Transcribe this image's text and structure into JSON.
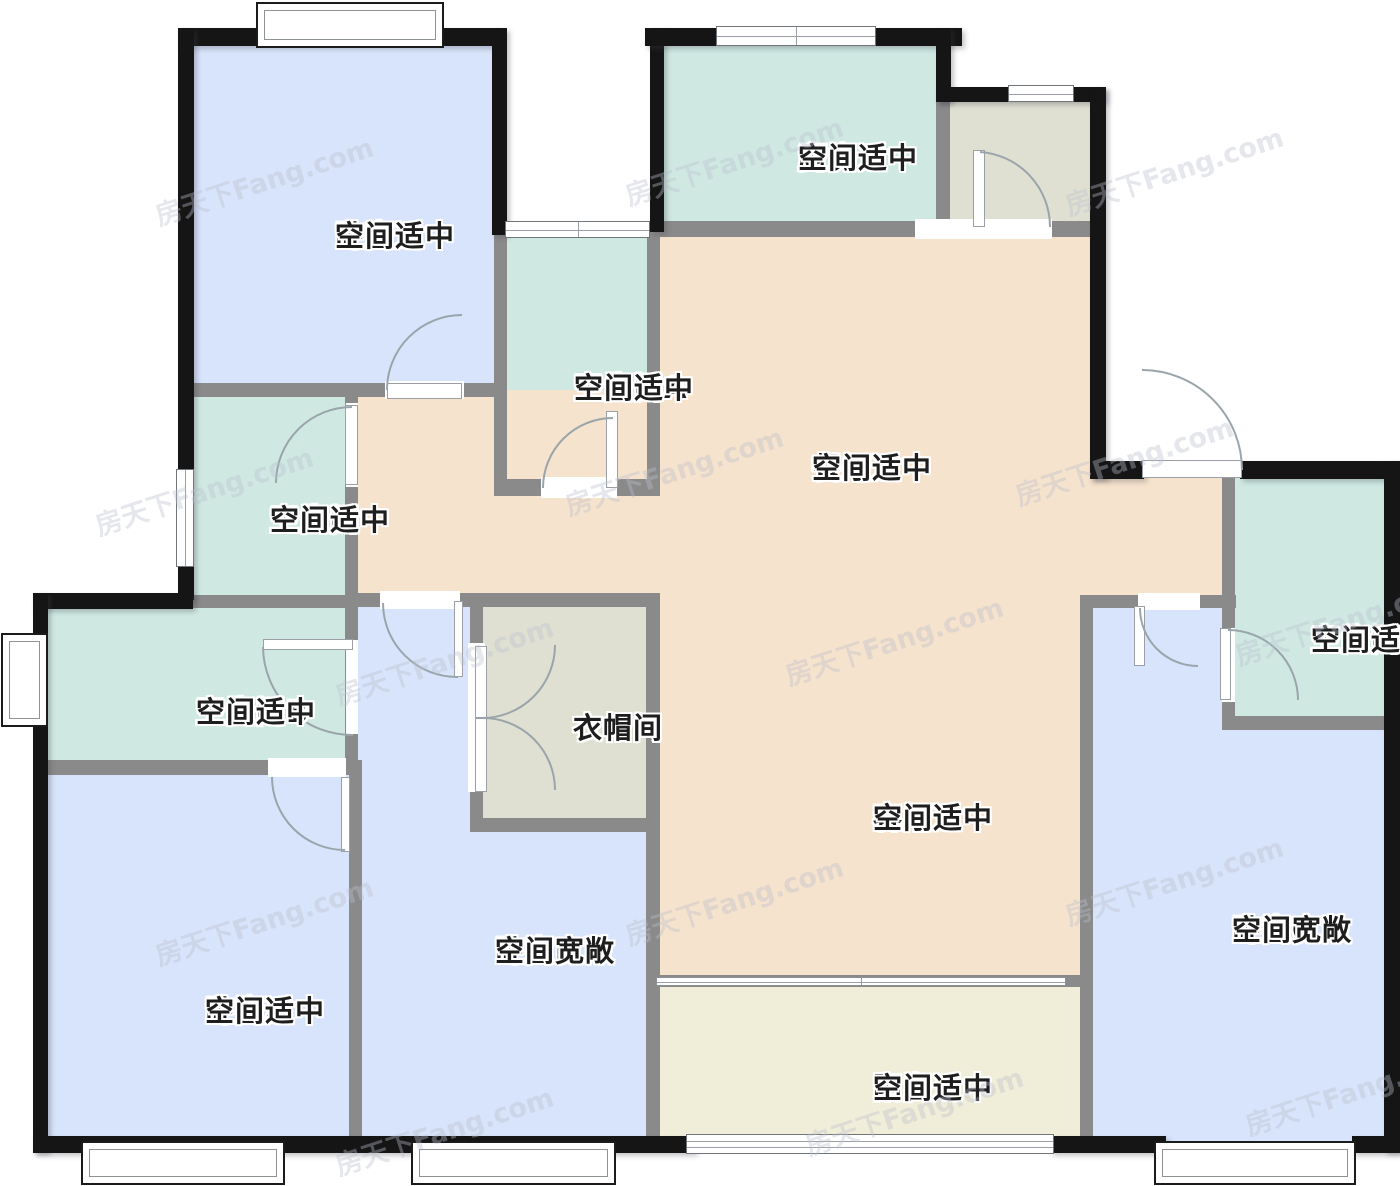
{
  "title": "户型图",
  "watermark": {
    "text": "房天下Fang.com",
    "positions": [
      [
        150,
        160
      ],
      [
        620,
        140
      ],
      [
        1060,
        150
      ],
      [
        90,
        470
      ],
      [
        560,
        450
      ],
      [
        1010,
        440
      ],
      [
        330,
        640
      ],
      [
        780,
        620
      ],
      [
        1230,
        600
      ],
      [
        150,
        900
      ],
      [
        620,
        880
      ],
      [
        1060,
        860
      ],
      [
        330,
        1110
      ],
      [
        800,
        1090
      ],
      [
        1240,
        1070
      ]
    ]
  },
  "palette": {
    "blue": "#d8e4fb",
    "teal": "#cfe9e2",
    "peach": "#f6e3cd",
    "sage": "#dfe0d2",
    "cream": "#f0eed9",
    "wall": "#151515",
    "partition": "#8a8a8a",
    "arc": "#9aa5ab",
    "label": "#1e1e1e"
  },
  "rooms": [
    {
      "id": "bedroom-tl",
      "name": "卧室",
      "desc": "空间适中",
      "lx": 335,
      "ly": 218,
      "fill": "blue",
      "rects": [
        [
          186,
          36,
          310,
          351
        ]
      ]
    },
    {
      "id": "kitchen",
      "name": "厨房",
      "desc": "空间适中",
      "lx": 798,
      "ly": 140,
      "fill": "teal",
      "rects": [
        [
          652,
          40,
          290,
          187
        ]
      ]
    },
    {
      "id": "utility",
      "name": "",
      "desc": "",
      "lx": 0,
      "ly": 0,
      "fill": "sage",
      "rects": [
        [
          944,
          96,
          152,
          131
        ]
      ]
    },
    {
      "id": "bath-a",
      "name": "卫生间A",
      "desc": "空间适中",
      "lx": 574,
      "ly": 370,
      "fill": "teal",
      "rects": [
        [
          500,
          231,
          150,
          256
        ]
      ]
    },
    {
      "id": "dining",
      "name": "餐厅",
      "desc": "空间适中",
      "lx": 812,
      "ly": 450,
      "fill": "peach",
      "rects": [
        [
          652,
          230,
          445,
          258
        ],
        [
          352,
          390,
          305,
          212
        ],
        [
          1088,
          470,
          142,
          135
        ]
      ]
    },
    {
      "id": "living",
      "name": "客厅",
      "desc": "空间适中",
      "lx": 873,
      "ly": 800,
      "fill": "peach",
      "rects": [
        [
          652,
          480,
          436,
          505
        ]
      ]
    },
    {
      "id": "bath",
      "name": "卫生间",
      "desc": "空间适中",
      "lx": 270,
      "ly": 502,
      "fill": "teal",
      "rects": [
        [
          186,
          390,
          166,
          212
        ]
      ]
    },
    {
      "id": "bath-b",
      "name": "卫生间B",
      "desc": "空间适中",
      "lx": 196,
      "ly": 694,
      "fill": "teal",
      "rects": [
        [
          40,
          600,
          312,
          168
        ]
      ]
    },
    {
      "id": "bedroom-a",
      "name": "卧室A",
      "desc": "空间适中",
      "lx": 205,
      "ly": 993,
      "fill": "blue",
      "rects": [
        [
          40,
          768,
          316,
          375
        ]
      ]
    },
    {
      "id": "bedroom-b",
      "name": "卧室B",
      "desc": "空间宽敞",
      "lx": 495,
      "ly": 933,
      "fill": "blue",
      "rects": [
        [
          355,
          600,
          298,
          543
        ]
      ]
    },
    {
      "id": "cloak",
      "name": "衣帽间",
      "desc": "",
      "lx": 573,
      "ly": 710,
      "fill": "sage",
      "rects": [
        [
          476,
          600,
          178,
          226
        ]
      ]
    },
    {
      "id": "balcony",
      "name": "阳台",
      "desc": "空间适中",
      "lx": 873,
      "ly": 1070,
      "fill": "cream",
      "rects": [
        [
          652,
          980,
          436,
          163
        ]
      ]
    },
    {
      "id": "bedroom-c",
      "name": "卧室C",
      "desc": "空间宽敞",
      "lx": 1232,
      "ly": 912,
      "fill": "blue",
      "rects": [
        [
          1088,
          600,
          300,
          543
        ]
      ]
    },
    {
      "id": "bath-c",
      "name": "卫生间C",
      "desc": "空间适中",
      "lx": 1311,
      "ly": 622,
      "fill": "teal",
      "rects": [
        [
          1228,
          475,
          160,
          248
        ]
      ]
    }
  ],
  "walls": {
    "exterior": [
      [
        178,
        28,
        319,
        18
      ],
      [
        178,
        28,
        16,
        572
      ],
      [
        492,
        28,
        15,
        207
      ],
      [
        33,
        593,
        160,
        16
      ],
      [
        33,
        593,
        15,
        559
      ],
      [
        33,
        1136,
        662,
        17
      ],
      [
        650,
        28,
        14,
        204
      ],
      [
        645,
        28,
        317,
        18
      ],
      [
        936,
        28,
        15,
        74
      ],
      [
        936,
        87,
        170,
        15
      ],
      [
        1090,
        87,
        16,
        392
      ],
      [
        1090,
        461,
        54,
        18
      ],
      [
        1240,
        461,
        160,
        18
      ],
      [
        1384,
        461,
        16,
        691
      ],
      [
        1050,
        1136,
        116,
        17
      ],
      [
        1352,
        1136,
        48,
        17
      ]
    ],
    "interior": [
      [
        193,
        383,
        302,
        14
      ],
      [
        345,
        383,
        13,
        392
      ],
      [
        188,
        595,
        170,
        13
      ],
      [
        46,
        760,
        312,
        15
      ],
      [
        349,
        760,
        13,
        390
      ],
      [
        352,
        593,
        308,
        14
      ],
      [
        470,
        598,
        13,
        234
      ],
      [
        470,
        818,
        190,
        14
      ],
      [
        646,
        598,
        14,
        552
      ],
      [
        645,
        221,
        312,
        16
      ],
      [
        940,
        221,
        152,
        16
      ],
      [
        936,
        94,
        14,
        133
      ],
      [
        494,
        233,
        13,
        260
      ],
      [
        494,
        479,
        164,
        17
      ],
      [
        647,
        230,
        13,
        266
      ],
      [
        652,
        975,
        438,
        12
      ],
      [
        1080,
        595,
        13,
        555
      ],
      [
        1080,
        595,
        156,
        13
      ],
      [
        1222,
        470,
        13,
        260
      ],
      [
        1222,
        716,
        172,
        14
      ]
    ]
  },
  "openings": [
    [
      385,
      381,
      79,
      18
    ],
    [
      346,
      403,
      12,
      84
    ],
    [
      346,
      640,
      12,
      94
    ],
    [
      268,
      758,
      78,
      19
    ],
    [
      380,
      591,
      80,
      18
    ],
    [
      468,
      643,
      17,
      149
    ],
    [
      541,
      477,
      76,
      21
    ],
    [
      978,
      219,
      74,
      20
    ],
    [
      915,
      219,
      64,
      20
    ],
    [
      1138,
      593,
      62,
      17
    ],
    [
      1222,
      628,
      13,
      74
    ]
  ],
  "windows": [
    {
      "k": "bay",
      "x": 256,
      "y": 2,
      "w": 188,
      "h": 46
    },
    {
      "k": "fh",
      "x": 716,
      "y": 26,
      "w": 160,
      "h": 20,
      "div": 1
    },
    {
      "k": "fh",
      "x": 1008,
      "y": 85,
      "w": 66,
      "h": 17,
      "div": 0
    },
    {
      "k": "fh",
      "x": 505,
      "y": 221,
      "w": 145,
      "h": 17,
      "div": 1
    },
    {
      "k": "fv",
      "x": 176,
      "y": 469,
      "w": 18,
      "h": 98
    },
    {
      "k": "bay",
      "x": 1,
      "y": 633,
      "w": 47,
      "h": 94
    },
    {
      "k": "bay",
      "x": 81,
      "y": 1141,
      "w": 204,
      "h": 44
    },
    {
      "k": "bay",
      "x": 411,
      "y": 1141,
      "w": 205,
      "h": 44
    },
    {
      "k": "glz",
      "x": 686,
      "y": 1134,
      "w": 368,
      "h": 20
    },
    {
      "k": "bay",
      "x": 1154,
      "y": 1141,
      "w": 202,
      "h": 44
    },
    {
      "k": "sld",
      "x": 656,
      "y": 977,
      "w": 410,
      "h": 9
    }
  ],
  "door_leaves": [
    [
      387,
      383,
      75,
      16
    ],
    [
      345,
      405,
      13,
      80
    ],
    [
      263,
      639,
      90,
      11
    ],
    [
      341,
      777,
      9,
      75
    ],
    [
      454,
      601,
      9,
      76
    ],
    [
      475,
      646,
      12,
      72
    ],
    [
      475,
      718,
      12,
      74
    ],
    [
      606,
      411,
      12,
      77
    ],
    [
      973,
      150,
      12,
      77
    ],
    [
      1142,
      460,
      100,
      18
    ],
    [
      1134,
      606,
      11,
      60
    ],
    [
      1220,
      628,
      11,
      72
    ]
  ],
  "door_arcs": [
    [
      387,
      390,
      75,
      1,
      462,
      315
    ],
    [
      352,
      407,
      76,
      0,
      276,
      483
    ],
    [
      263,
      647,
      89,
      0,
      353,
      735
    ],
    [
      272,
      777,
      73,
      0,
      345,
      850
    ],
    [
      383,
      603,
      74,
      0,
      458,
      677
    ],
    [
      482,
      718,
      73,
      0,
      555,
      645
    ],
    [
      482,
      718,
      72,
      1,
      555,
      790
    ],
    [
      543,
      488,
      70,
      1,
      613,
      418
    ],
    [
      980,
      152,
      75,
      1,
      1050,
      227
    ],
    [
      1242,
      470,
      100,
      0,
      1142,
      370
    ],
    [
      1140,
      608,
      58,
      0,
      1198,
      666
    ],
    [
      1228,
      630,
      70,
      1,
      1298,
      700
    ]
  ]
}
